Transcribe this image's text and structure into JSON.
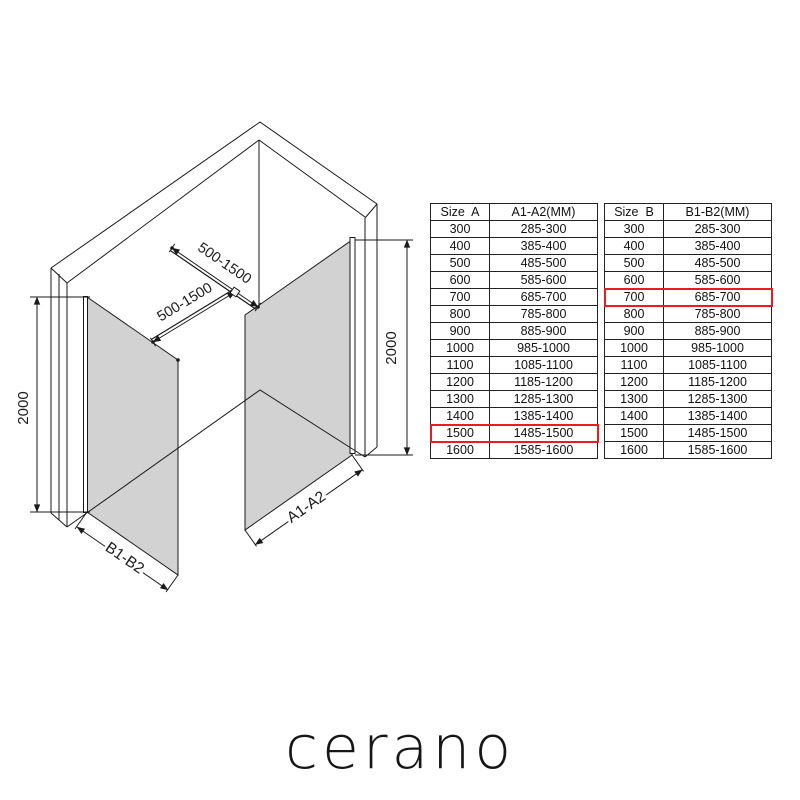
{
  "page": {
    "background": "#ffffff",
    "logo_text": "cerano"
  },
  "diagram": {
    "labels": {
      "bar_top": "500-1500",
      "bar_bottom": "500-1500",
      "height_left": "2000",
      "height_right": "2000",
      "panel_left_width": "B1-B2",
      "panel_right_width": "A1-A2"
    },
    "colors": {
      "line": "#1a1a1a",
      "glass": "#d2d2d2"
    }
  },
  "highlight_color": "#ed1c1c",
  "tables": [
    {
      "id": "size-a",
      "headers": [
        "Size  A",
        "A1-A2(MM)"
      ],
      "rows": [
        [
          "300",
          "285-300"
        ],
        [
          "400",
          "385-400"
        ],
        [
          "500",
          "485-500"
        ],
        [
          "600",
          "585-600"
        ],
        [
          "700",
          "685-700"
        ],
        [
          "800",
          "785-800"
        ],
        [
          "900",
          "885-900"
        ],
        [
          "1000",
          "985-1000"
        ],
        [
          "1100",
          "1085-1100"
        ],
        [
          "1200",
          "1185-1200"
        ],
        [
          "1300",
          "1285-1300"
        ],
        [
          "1400",
          "1385-1400"
        ],
        [
          "1500",
          "1485-1500"
        ],
        [
          "1600",
          "1585-1600"
        ]
      ],
      "highlight_row": "1500"
    },
    {
      "id": "size-b",
      "headers": [
        "Size  B",
        "B1-B2(MM)"
      ],
      "rows": [
        [
          "300",
          "285-300"
        ],
        [
          "400",
          "385-400"
        ],
        [
          "500",
          "485-500"
        ],
        [
          "600",
          "585-600"
        ],
        [
          "700",
          "685-700"
        ],
        [
          "800",
          "785-800"
        ],
        [
          "900",
          "885-900"
        ],
        [
          "1000",
          "985-1000"
        ],
        [
          "1100",
          "1085-1100"
        ],
        [
          "1200",
          "1185-1200"
        ],
        [
          "1300",
          "1285-1300"
        ],
        [
          "1400",
          "1385-1400"
        ],
        [
          "1500",
          "1485-1500"
        ],
        [
          "1600",
          "1585-1600"
        ]
      ],
      "highlight_row": "700"
    }
  ]
}
